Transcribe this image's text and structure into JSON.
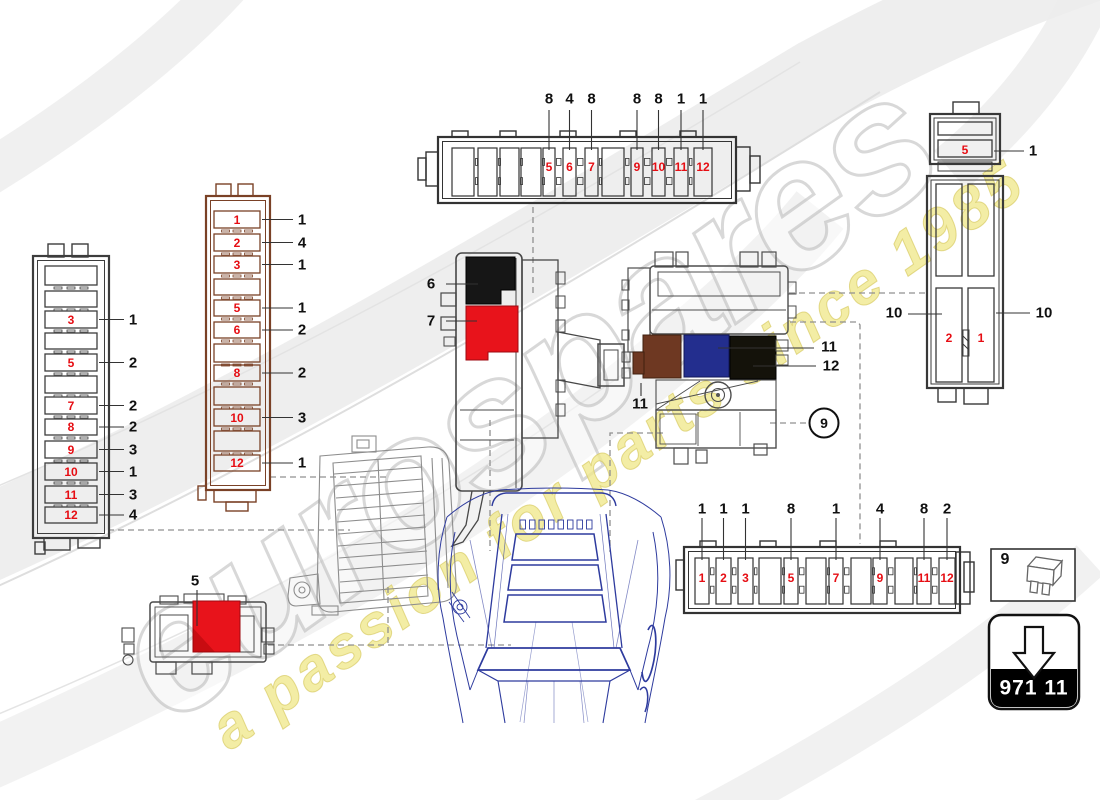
{
  "watermark": {
    "brand": "eurospares",
    "tagline": "a passion for parts since 1985",
    "brand_color": "#cccccc",
    "tagline_color": "#efe78c"
  },
  "colors": {
    "fuse_number_red": "#e60d13",
    "callout_black": "#101010",
    "housing_gray": "#383838",
    "housing_brown": "#7a4126",
    "connector_black": "#161616",
    "connector_red": "#e8131b",
    "connector_brown": "#6e3822",
    "connector_blue": "#232e8e",
    "connector_dark_olive": "#14120a",
    "car_line_blue": "#2e3b9e",
    "dash_gray": "#909090"
  },
  "components": {
    "fusebox_left": {
      "slot_labels": [
        "",
        "",
        "3",
        "",
        "5",
        "",
        "7",
        "8",
        "9",
        "10",
        "11",
        "12"
      ],
      "callouts": [
        {
          "slot": 3,
          "ref": "1"
        },
        {
          "slot": 5,
          "ref": "2"
        },
        {
          "slot": 7,
          "ref": "2"
        },
        {
          "slot": 8,
          "ref": "2"
        },
        {
          "slot": 9,
          "ref": "3"
        },
        {
          "slot": 10,
          "ref": "1"
        },
        {
          "slot": 11,
          "ref": "3"
        },
        {
          "slot": 12,
          "ref": "4"
        }
      ]
    },
    "fusebox_brown": {
      "slot_labels": [
        "1",
        "2",
        "3",
        "",
        "5",
        "6",
        "",
        "8",
        "",
        "10",
        "",
        "12"
      ],
      "callouts": [
        {
          "slot": 1,
          "ref": "1"
        },
        {
          "slot": 2,
          "ref": "4"
        },
        {
          "slot": 3,
          "ref": "1"
        },
        {
          "slot": 5,
          "ref": "1"
        },
        {
          "slot": 6,
          "ref": "2"
        },
        {
          "slot": 8,
          "ref": "2"
        },
        {
          "slot": 10,
          "ref": "3"
        },
        {
          "slot": 12,
          "ref": "1"
        }
      ]
    },
    "strip_top": {
      "slot_labels": [
        "",
        "",
        "",
        "",
        "5",
        "6",
        "7",
        "",
        "9",
        "10",
        "11",
        "12"
      ],
      "callouts": [
        {
          "slot": 5,
          "ref": "8"
        },
        {
          "slot": 6,
          "ref": "4"
        },
        {
          "slot": 7,
          "ref": "8"
        },
        {
          "slot": 9,
          "ref": "8"
        },
        {
          "slot": 10,
          "ref": "8"
        },
        {
          "slot": 11,
          "ref": "1"
        },
        {
          "slot": 12,
          "ref": "1"
        }
      ]
    },
    "strip_bottom": {
      "slot_labels": [
        "1",
        "2",
        "3",
        "",
        "5",
        "",
        "7",
        "",
        "9",
        "",
        "11",
        "12"
      ],
      "callouts": [
        {
          "slot": 1,
          "ref": "1"
        },
        {
          "slot": 2,
          "ref": "1"
        },
        {
          "slot": 3,
          "ref": "1"
        },
        {
          "slot": 5,
          "ref": "8"
        },
        {
          "slot": 7,
          "ref": "1"
        },
        {
          "slot": 9,
          "ref": "4"
        },
        {
          "slot": 11,
          "ref": "8"
        },
        {
          "slot": 12,
          "ref": "2"
        }
      ]
    },
    "fusebox_topright": {
      "top_slot_label": "5",
      "top_callout": "1",
      "left_slot_label": "2",
      "right_slot_label": "1",
      "left_callout": "10",
      "right_callout": "10"
    },
    "relay_mid": {
      "callout_black": "6",
      "callout_red": "7"
    },
    "unit_right": {
      "callout_brown": "11",
      "callout_blue": "11",
      "callout_black": "12",
      "circled_ref": "9"
    },
    "block_small": {
      "callout": "5"
    },
    "legend_box": {
      "ref": "9"
    },
    "part_box": {
      "part_number": "971 11"
    }
  }
}
